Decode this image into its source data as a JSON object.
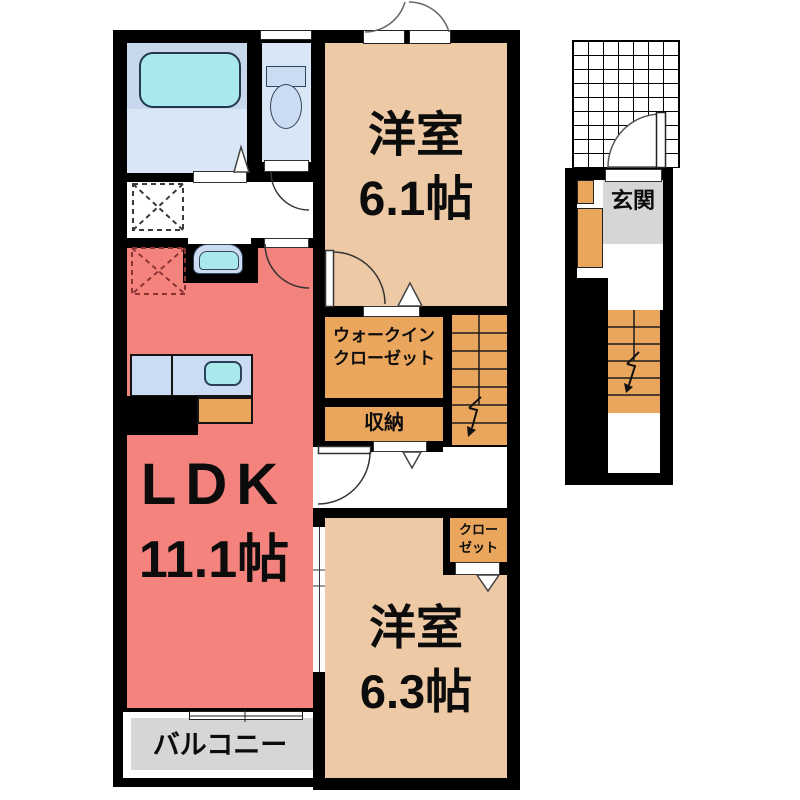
{
  "plan": {
    "rooms": {
      "western_room_1": {
        "name": "洋室",
        "size": "6.1帖"
      },
      "walk_in_closet": {
        "line1": "ウォークイン",
        "line2": "クローゼット"
      },
      "storage": {
        "name": "収納"
      },
      "ldk": {
        "name": "LDK",
        "size": "11.1帖"
      },
      "closet": {
        "line1": "クロー",
        "line2": "ゼット"
      },
      "western_room_2": {
        "name": "洋室",
        "size": "6.3帖"
      },
      "balcony": {
        "name": "バルコニー"
      },
      "entrance": {
        "name": "玄関"
      }
    },
    "colors": {
      "wall": "#000000",
      "room_tan": "#edc9a5",
      "ldk_salmon": "#f4837e",
      "storage_orange": "#eaa65c",
      "bath_floor_blue": "#d8e6f6",
      "bath_deck_blue": "#c7d8ec",
      "water_cyan": "#a9e9ec",
      "fixture_blue": "#cbdcf2",
      "gray_area": "#d6d6d6",
      "background": "#ffffff"
    }
  }
}
